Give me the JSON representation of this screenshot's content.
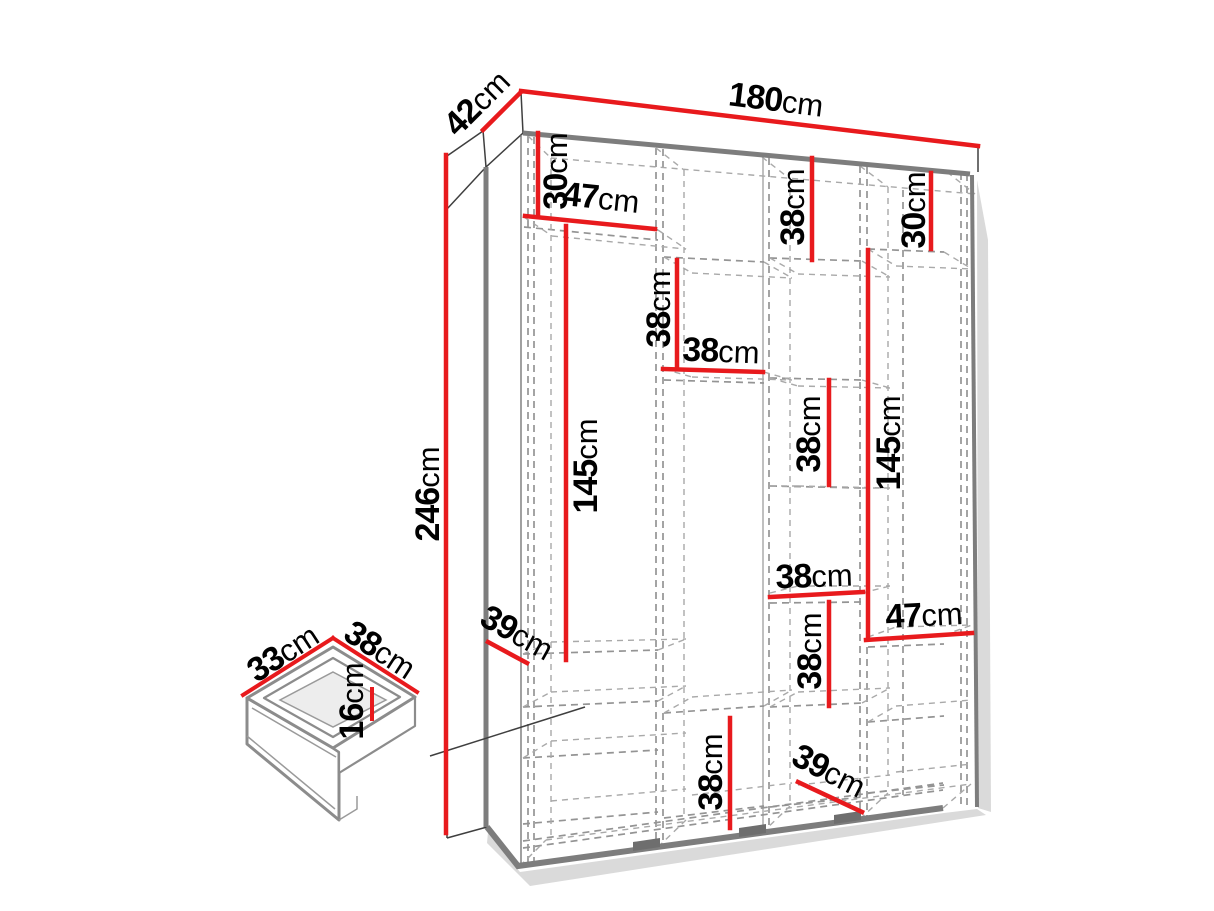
{
  "diagram": {
    "kind": "furniture dimension drawing",
    "subject": "four-section wardrobe with internal shelves and drawer detail"
  },
  "colors": {
    "red": "#e81a1d",
    "outline": "#3f3f3f",
    "carcass": "#7d7d7d",
    "dash": "#949494",
    "dashlight": "#a9a9a9",
    "shadow": "#dadada",
    "feet": "#6e6e6e",
    "text": "#000000"
  },
  "dimensions": [
    {
      "id": "wardrobe-width",
      "value": "180",
      "unit": "cm"
    },
    {
      "id": "wardrobe-depth",
      "value": "42",
      "unit": "cm"
    },
    {
      "id": "wardrobe-height",
      "value": "246",
      "unit": "cm"
    },
    {
      "id": "section1-top-gap",
      "value": "30",
      "unit": "cm"
    },
    {
      "id": "section1-width",
      "value": "47",
      "unit": "cm"
    },
    {
      "id": "section1-hanging-height",
      "value": "145",
      "unit": "cm"
    },
    {
      "id": "section1-shelf-depth",
      "value": "39",
      "unit": "cm"
    },
    {
      "id": "section2-upper-gap",
      "value": "38",
      "unit": "cm"
    },
    {
      "id": "section2-width",
      "value": "38",
      "unit": "cm"
    },
    {
      "id": "section3-top-gap",
      "value": "38",
      "unit": "cm"
    },
    {
      "id": "section3-mid-gap",
      "value": "38",
      "unit": "cm"
    },
    {
      "id": "section4-hanging-height",
      "value": "145",
      "unit": "cm"
    },
    {
      "id": "section4-top-gap",
      "value": "30",
      "unit": "cm"
    },
    {
      "id": "section3-width",
      "value": "38",
      "unit": "cm"
    },
    {
      "id": "section3-lower-gap",
      "value": "38",
      "unit": "cm"
    },
    {
      "id": "section2-bottom-gap",
      "value": "38",
      "unit": "cm"
    },
    {
      "id": "section4-width",
      "value": "47",
      "unit": "cm"
    },
    {
      "id": "section3-bottom-depth",
      "value": "39",
      "unit": "cm"
    },
    {
      "id": "drawer-width",
      "value": "33",
      "unit": "cm"
    },
    {
      "id": "drawer-depth",
      "value": "38",
      "unit": "cm"
    },
    {
      "id": "drawer-height",
      "value": "16",
      "unit": "cm"
    }
  ]
}
